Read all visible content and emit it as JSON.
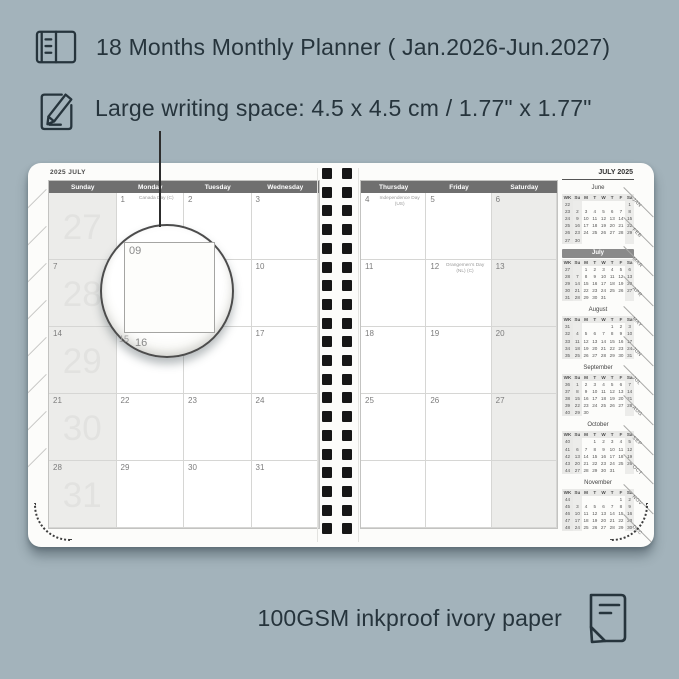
{
  "colors": {
    "background": "#a3b3bb",
    "ink": "#26343c",
    "page": "#fcfcfa",
    "header_bar": "#6f6f6f",
    "shaded_column": "#ececea",
    "mini_highlight_bar": "#8a8a8a",
    "binding_hole": "#161616"
  },
  "annotations": {
    "title": "18 Months Monthly Planner ( Jan.2026-Jun.2027)",
    "writing_space": "Large writing space: 4.5 x 4.5 cm / 1.77\" x 1.77\"",
    "paper": "100GSM inkproof ivory paper"
  },
  "icons": {
    "title_icon": "open-planner-book",
    "writing_icon": "pencil-on-paper",
    "paper_icon": "paper-sheet-folded-corner"
  },
  "planner": {
    "binding_holes": 20,
    "left_edge_tab_marks": 8,
    "magnifier": {
      "date": "09",
      "below_left": "15",
      "below_right": "16"
    },
    "left_page": {
      "title": "2025 JULY",
      "day_headers": [
        "Sunday",
        "Monday",
        "Tuesday",
        "Wednesday"
      ],
      "weeks": [
        {
          "week_number": "27",
          "cells": [
            {
              "date": ""
            },
            {
              "date": "1",
              "note": "Canada Day (C)"
            },
            {
              "date": "2"
            },
            {
              "date": "3"
            }
          ]
        },
        {
          "week_number": "28",
          "cells": [
            {
              "date": "7"
            },
            {
              "date": "8"
            },
            {
              "date": "9"
            },
            {
              "date": "10"
            }
          ]
        },
        {
          "week_number": "29",
          "cells": [
            {
              "date": "14"
            },
            {
              "date": "15"
            },
            {
              "date": "16"
            },
            {
              "date": "17"
            }
          ]
        },
        {
          "week_number": "30",
          "cells": [
            {
              "date": "21"
            },
            {
              "date": "22"
            },
            {
              "date": "23"
            },
            {
              "date": "24"
            }
          ]
        },
        {
          "week_number": "31",
          "cells": [
            {
              "date": "28"
            },
            {
              "date": "29"
            },
            {
              "date": "30"
            },
            {
              "date": "31"
            }
          ]
        }
      ]
    },
    "right_page": {
      "corner_title": "JULY 2025",
      "day_headers": [
        "Thursday",
        "Friday",
        "Saturday"
      ],
      "weeks": [
        [
          {
            "date": "4",
            "note": "Independence Day (US)"
          },
          {
            "date": "5"
          },
          {
            "date": "6"
          }
        ],
        [
          {
            "date": "11"
          },
          {
            "date": "12",
            "note": "Orangemen's Day (NL) (C)"
          },
          {
            "date": "13"
          }
        ],
        [
          {
            "date": "18"
          },
          {
            "date": "19"
          },
          {
            "date": "20"
          }
        ],
        [
          {
            "date": "25"
          },
          {
            "date": "26"
          },
          {
            "date": "27"
          }
        ],
        [
          {
            "date": ""
          },
          {
            "date": ""
          },
          {
            "date": ""
          }
        ]
      ],
      "tabs": [
        "JAN",
        "FEB",
        "MAR",
        "APR",
        "MAY",
        "JUN",
        "JUL",
        "AUG",
        "SEP",
        "OCT",
        "NOV",
        "DEC"
      ],
      "mini_dow": [
        "WK",
        "Su",
        "M",
        "T",
        "W",
        "T",
        "F",
        "Sa"
      ],
      "mini_calendars": [
        {
          "name": "June",
          "highlight": false,
          "weeks": [
            [
              "22",
              "",
              "",
              "",
              "",
              "",
              "",
              "1"
            ],
            [
              "23",
              "2",
              "3",
              "4",
              "5",
              "6",
              "7",
              "8"
            ],
            [
              "24",
              "9",
              "10",
              "11",
              "12",
              "13",
              "14",
              "15"
            ],
            [
              "25",
              "16",
              "17",
              "18",
              "19",
              "20",
              "21",
              "22"
            ],
            [
              "26",
              "23",
              "24",
              "25",
              "26",
              "27",
              "28",
              "29"
            ],
            [
              "27",
              "30",
              "",
              "",
              "",
              "",
              "",
              ""
            ]
          ]
        },
        {
          "name": "July",
          "highlight": true,
          "weeks": [
            [
              "27",
              "",
              "1",
              "2",
              "3",
              "4",
              "5",
              "6"
            ],
            [
              "28",
              "7",
              "8",
              "9",
              "10",
              "11",
              "12",
              "13"
            ],
            [
              "29",
              "14",
              "15",
              "16",
              "17",
              "18",
              "19",
              "20"
            ],
            [
              "30",
              "21",
              "22",
              "23",
              "24",
              "25",
              "26",
              "27"
            ],
            [
              "31",
              "28",
              "29",
              "30",
              "31",
              "",
              "",
              ""
            ]
          ]
        },
        {
          "name": "August",
          "highlight": false,
          "weeks": [
            [
              "31",
              "",
              "",
              "",
              "",
              "1",
              "2",
              "3"
            ],
            [
              "32",
              "4",
              "5",
              "6",
              "7",
              "8",
              "9",
              "10"
            ],
            [
              "33",
              "11",
              "12",
              "13",
              "14",
              "15",
              "16",
              "17"
            ],
            [
              "34",
              "18",
              "19",
              "20",
              "21",
              "22",
              "23",
              "24"
            ],
            [
              "35",
              "25",
              "26",
              "27",
              "28",
              "29",
              "30",
              "31"
            ]
          ]
        },
        {
          "name": "September",
          "highlight": false,
          "weeks": [
            [
              "36",
              "1",
              "2",
              "3",
              "4",
              "5",
              "6",
              "7"
            ],
            [
              "37",
              "8",
              "9",
              "10",
              "11",
              "12",
              "13",
              "14"
            ],
            [
              "38",
              "15",
              "16",
              "17",
              "18",
              "19",
              "20",
              "21"
            ],
            [
              "39",
              "22",
              "23",
              "24",
              "25",
              "26",
              "27",
              "28"
            ],
            [
              "40",
              "29",
              "30",
              "",
              "",
              "",
              "",
              ""
            ]
          ]
        },
        {
          "name": "October",
          "highlight": false,
          "weeks": [
            [
              "40",
              "",
              "",
              "1",
              "2",
              "3",
              "4",
              "5"
            ],
            [
              "41",
              "6",
              "7",
              "8",
              "9",
              "10",
              "11",
              "12"
            ],
            [
              "42",
              "13",
              "14",
              "15",
              "16",
              "17",
              "18",
              "19"
            ],
            [
              "43",
              "20",
              "21",
              "22",
              "23",
              "24",
              "25",
              "26"
            ],
            [
              "44",
              "27",
              "28",
              "29",
              "30",
              "31",
              "",
              ""
            ]
          ]
        },
        {
          "name": "November",
          "highlight": false,
          "weeks": [
            [
              "44",
              "",
              "",
              "",
              "",
              "",
              "1",
              "2"
            ],
            [
              "45",
              "3",
              "4",
              "5",
              "6",
              "7",
              "8",
              "9"
            ],
            [
              "46",
              "10",
              "11",
              "12",
              "13",
              "14",
              "15",
              "16"
            ],
            [
              "47",
              "17",
              "18",
              "19",
              "20",
              "21",
              "22",
              "23"
            ],
            [
              "48",
              "24",
              "25",
              "26",
              "27",
              "28",
              "29",
              "30"
            ]
          ]
        }
      ]
    }
  }
}
